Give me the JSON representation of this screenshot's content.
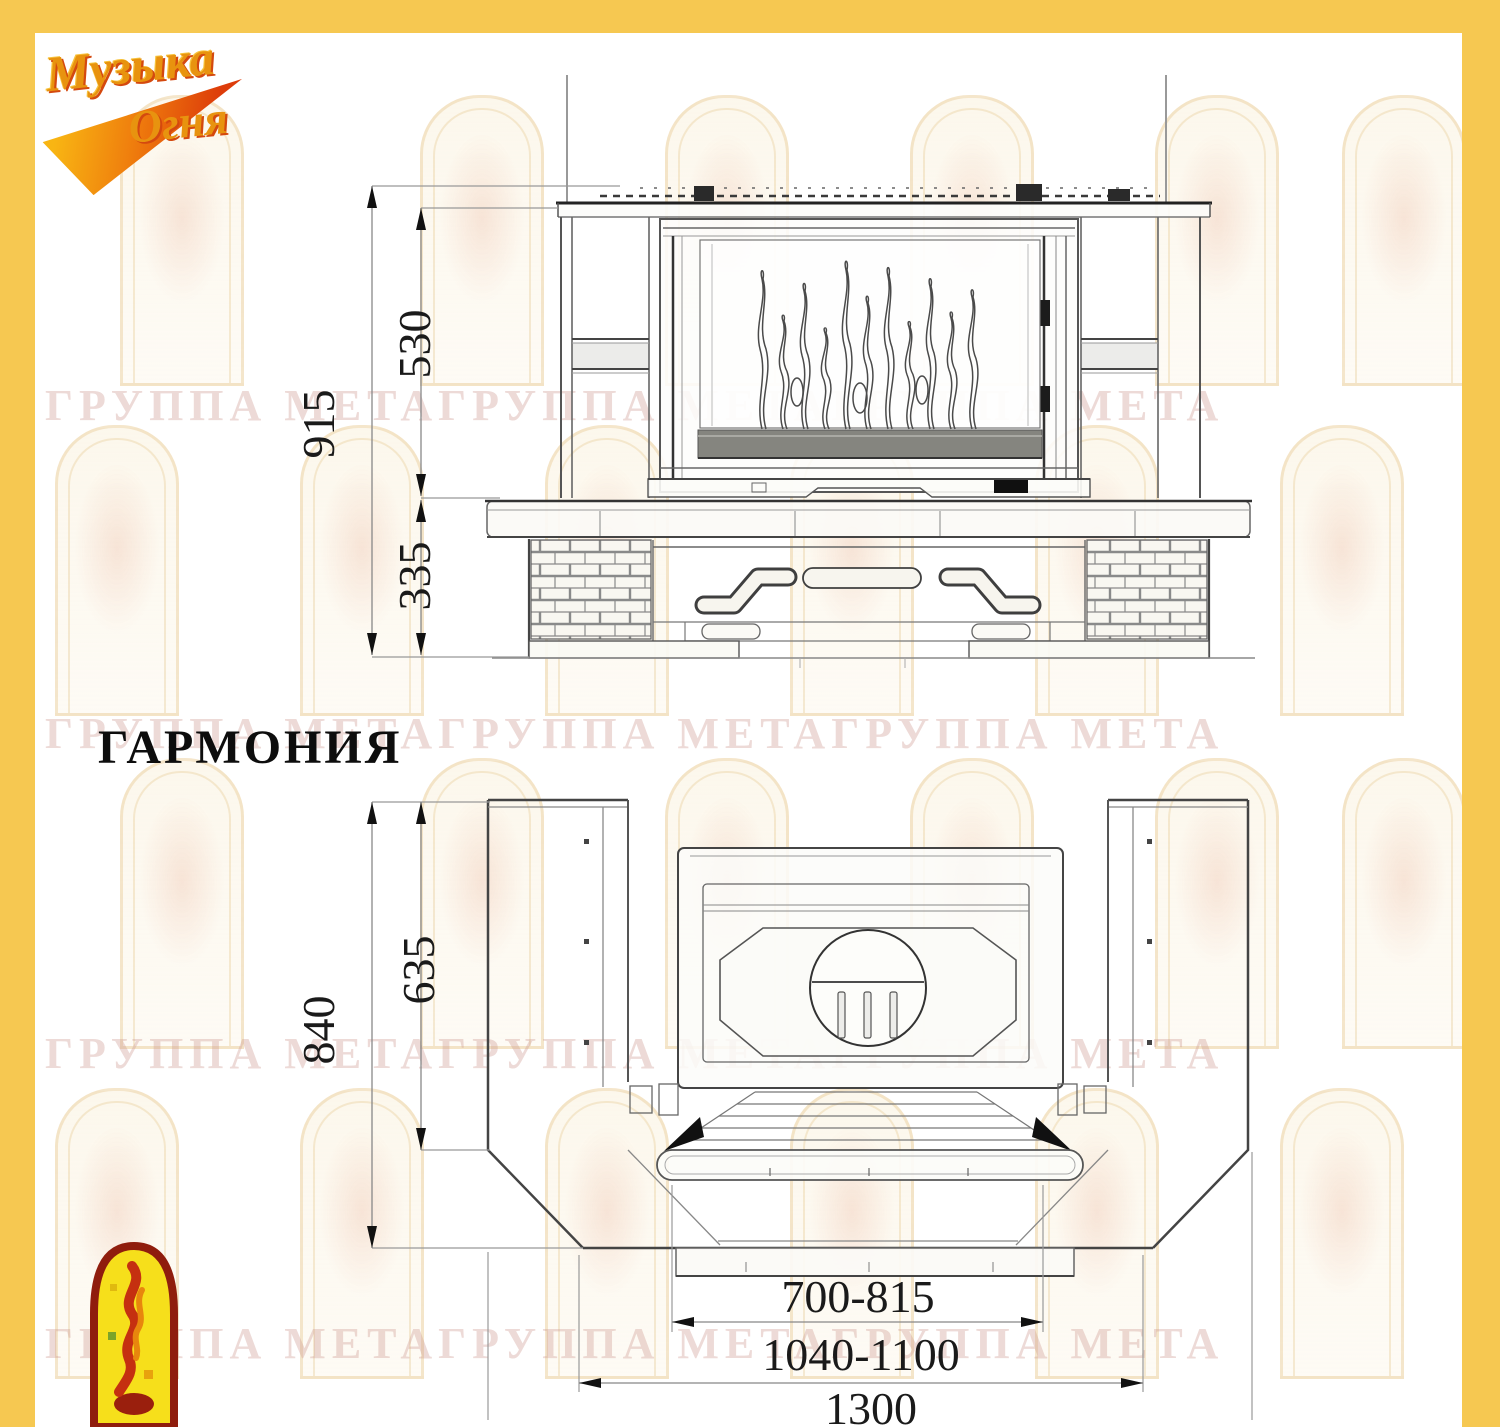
{
  "frame": {
    "color": "#f6c851"
  },
  "logo_top": {
    "line1": "Музыка",
    "line2": "Огня"
  },
  "title": "ГАРМОНИЯ",
  "watermark": {
    "text": "ГРУППА МЕТАГРУППА МЕТАГРУППА МЕТА"
  },
  "front_view": {
    "dim_total_height": "915",
    "dim_upper_height": "530",
    "dim_base_height": "335"
  },
  "plan_view": {
    "dim_total_depth": "840",
    "dim_side_depth": "635",
    "dim_firebox_width": "700-815",
    "dim_face_width": "1040-1100",
    "dim_total_width": "1300"
  }
}
